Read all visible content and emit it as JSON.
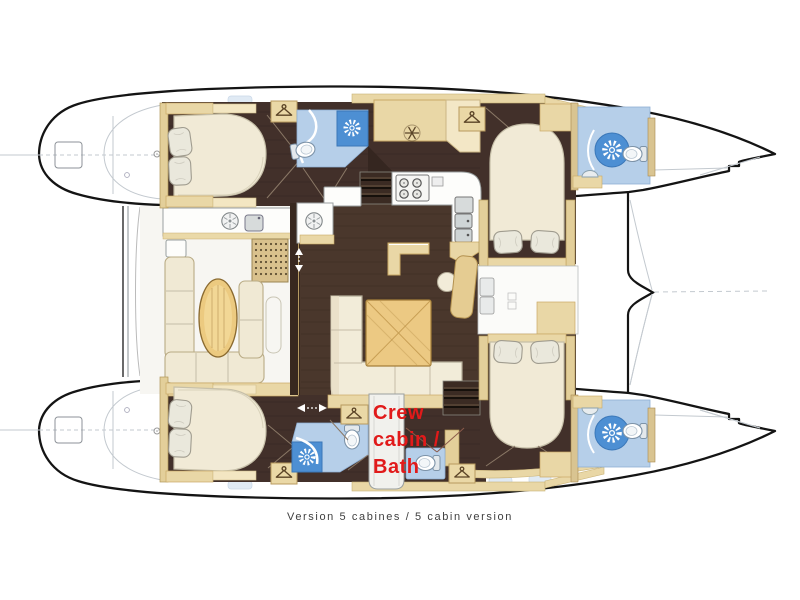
{
  "diagram": {
    "type": "catamaran floor plan",
    "caption": "Version 5 cabines / 5 cabin version",
    "annotation": {
      "text": "Crew cabin / Bath",
      "lines": [
        "Crew",
        "cabin /",
        "Bath"
      ],
      "color": "#e11a1a"
    },
    "palette": {
      "hull_outline": "#141414",
      "floor_dark_brown": "#46332a",
      "furniture_beige": "#e9d7a6",
      "cushion_cream": "#f1ead6",
      "table_wood": "#ecc983",
      "bath_floor_blue": "#b6cfe9",
      "shower_blue": "#4d8fd3",
      "caption_grey": "#3f3f3f",
      "annotation_red": "#e11a1a"
    },
    "icons": [
      "hanger-icon",
      "snowflake-icon",
      "shower-starburst-icon",
      "toilet-icon",
      "round-sink-icon",
      "stove-burner-icon",
      "double-arrow-icon"
    ]
  }
}
